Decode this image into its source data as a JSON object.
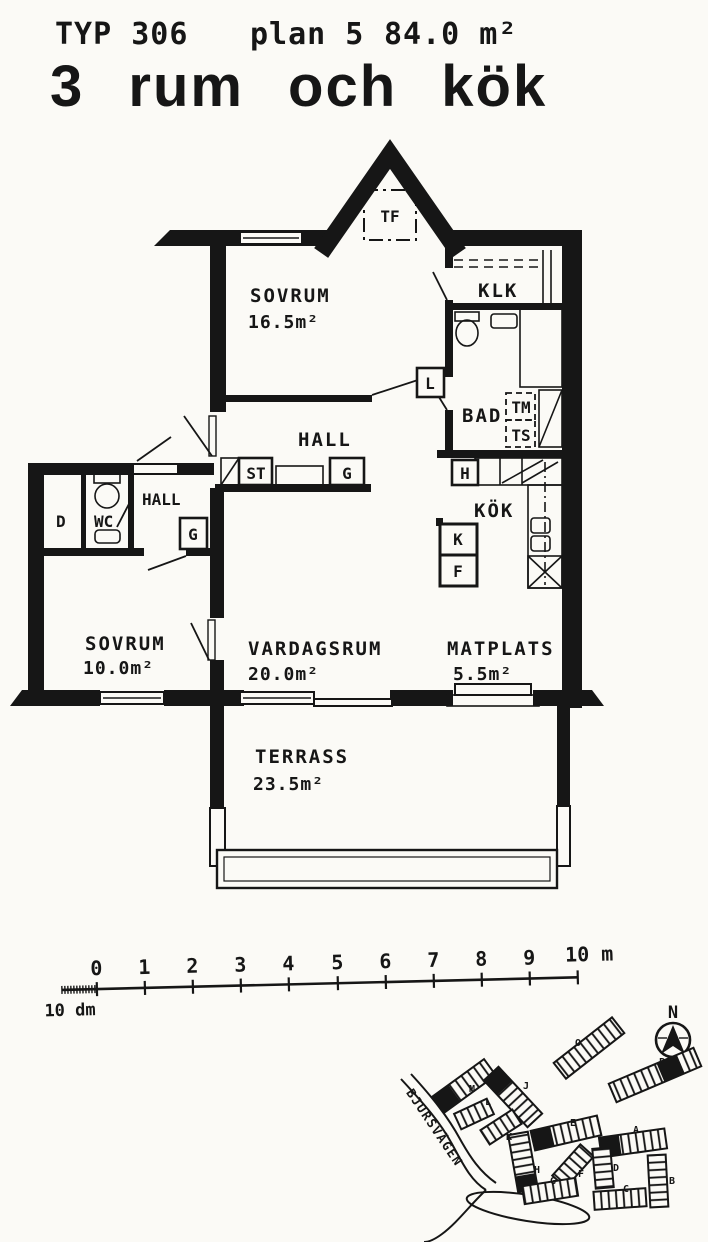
{
  "header": {
    "type_label": "TYP 306",
    "plan_label": "plan 5",
    "area_label": "84.0 m²",
    "title": "3 rum och kök"
  },
  "rooms": {
    "sovrum_main": {
      "name": "SOVRUM",
      "area": "16.5m²"
    },
    "klk": {
      "name": "KLK"
    },
    "bad": {
      "name": "BAD"
    },
    "hall_main": {
      "name": "HALL"
    },
    "kok": {
      "name": "KÖK"
    },
    "hall_entry": {
      "name": "HALL"
    },
    "wc": {
      "name": "WC"
    },
    "dusch": {
      "name": "D"
    },
    "sovrum_small": {
      "name": "SOVRUM",
      "area": "10.0m²"
    },
    "vardagsrum": {
      "name": "VARDAGSRUM",
      "area": "20.0m²"
    },
    "matplats": {
      "name": "MATPLATS",
      "area": "5.5m²"
    },
    "terrass": {
      "name": "TERRASS",
      "area": "23.5m²"
    }
  },
  "fixtures": {
    "tf": "TF",
    "l": "L",
    "tm": "TM",
    "ts": "TS",
    "st": "ST",
    "g_hall": "G",
    "g_entry": "G",
    "h": "H",
    "k": "K",
    "f": "F"
  },
  "scale_bar": {
    "tick_labels": [
      "0",
      "1",
      "2",
      "3",
      "4",
      "5",
      "6",
      "7",
      "8",
      "9"
    ],
    "end_label": "10 m",
    "sub_label": "10 dm"
  },
  "site_plan": {
    "north_label": "N",
    "street_name": "BJURSVÄGEN",
    "buildings": [
      {
        "id": "O",
        "highlighted": false
      },
      {
        "id": "P",
        "highlighted": true
      },
      {
        "id": "M",
        "highlighted": true
      },
      {
        "id": "J",
        "highlighted": true
      },
      {
        "id": "L",
        "highlighted": false
      },
      {
        "id": "K",
        "highlighted": false
      },
      {
        "id": "E",
        "highlighted": true
      },
      {
        "id": "A",
        "highlighted": true
      },
      {
        "id": "H",
        "highlighted": true
      },
      {
        "id": "F",
        "highlighted": false
      },
      {
        "id": "D",
        "highlighted": false
      },
      {
        "id": "G",
        "highlighted": false
      },
      {
        "id": "C",
        "highlighted": false
      },
      {
        "id": "B",
        "highlighted": false
      }
    ]
  }
}
